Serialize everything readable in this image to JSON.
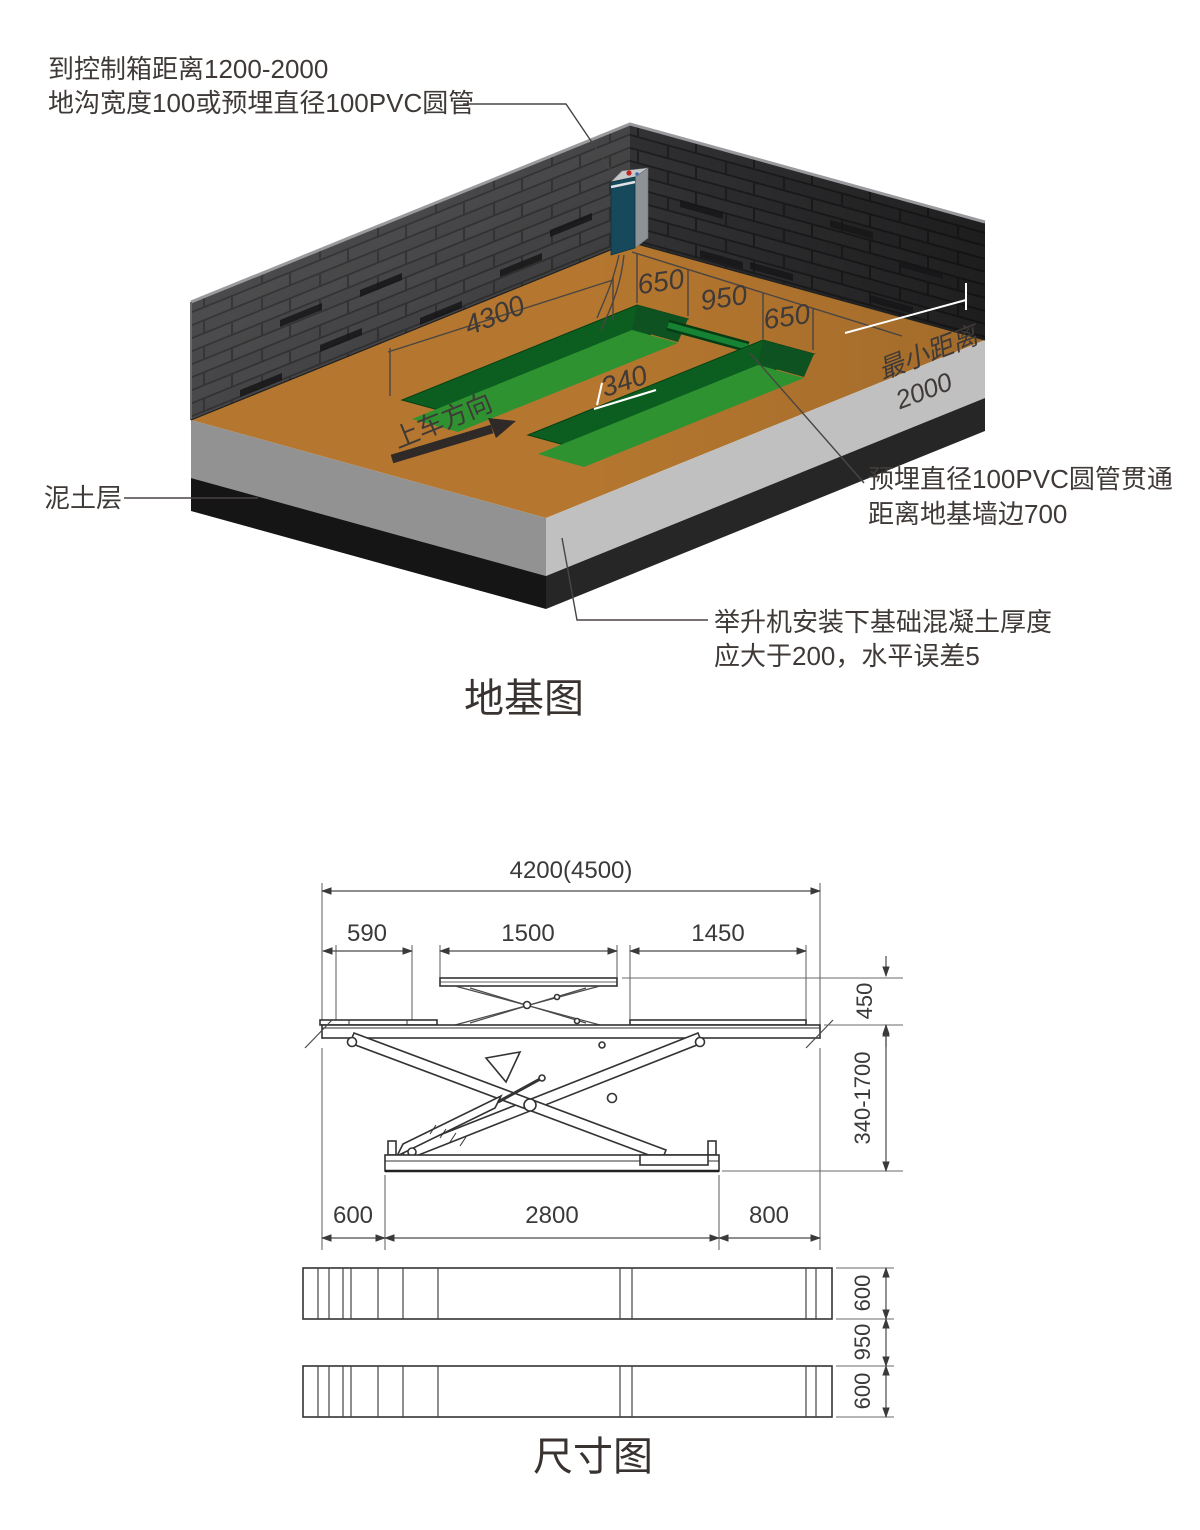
{
  "foundation": {
    "title": "地基图",
    "control_box_note": [
      "到控制箱距离1200-2000",
      "地沟宽度100或预埋直径100PVC圆管"
    ],
    "soil_label": "泥土层",
    "pvc_note": [
      "预埋直径100PVC圆管贯通",
      "距离地基墙边700"
    ],
    "concrete_note": [
      "举升机安装下基础混凝土厚度",
      "应大于200，水平误差5"
    ],
    "drive_direction": "上车方向",
    "min_distance": [
      "最小距离",
      "2000"
    ],
    "groove_length": "4300",
    "groove_widths": [
      "650",
      "950",
      "650"
    ],
    "groove_depth": "340"
  },
  "dimension_view": {
    "title": "尺寸图",
    "overall_length": "4200(4500)",
    "segment_dims": [
      "590",
      "1500",
      "1450"
    ],
    "top_platform_height": "450",
    "lift_height_range": "340-1700",
    "base_dims": [
      "600",
      "2800",
      "800"
    ],
    "runway_dims": [
      "600",
      "950",
      "600"
    ]
  },
  "colors": {
    "floor_brown": "#b5772f",
    "trench_green": "#2f9230",
    "trench_dark_green": "#0b5e20",
    "wall_brick": "#3a3a3c",
    "concrete_gray_left": "#929292",
    "concrete_gray_right": "#c0c0c0",
    "soil_black": "#151515",
    "control_box_teal": "#17495c",
    "annotation_line": "#4a4543"
  }
}
